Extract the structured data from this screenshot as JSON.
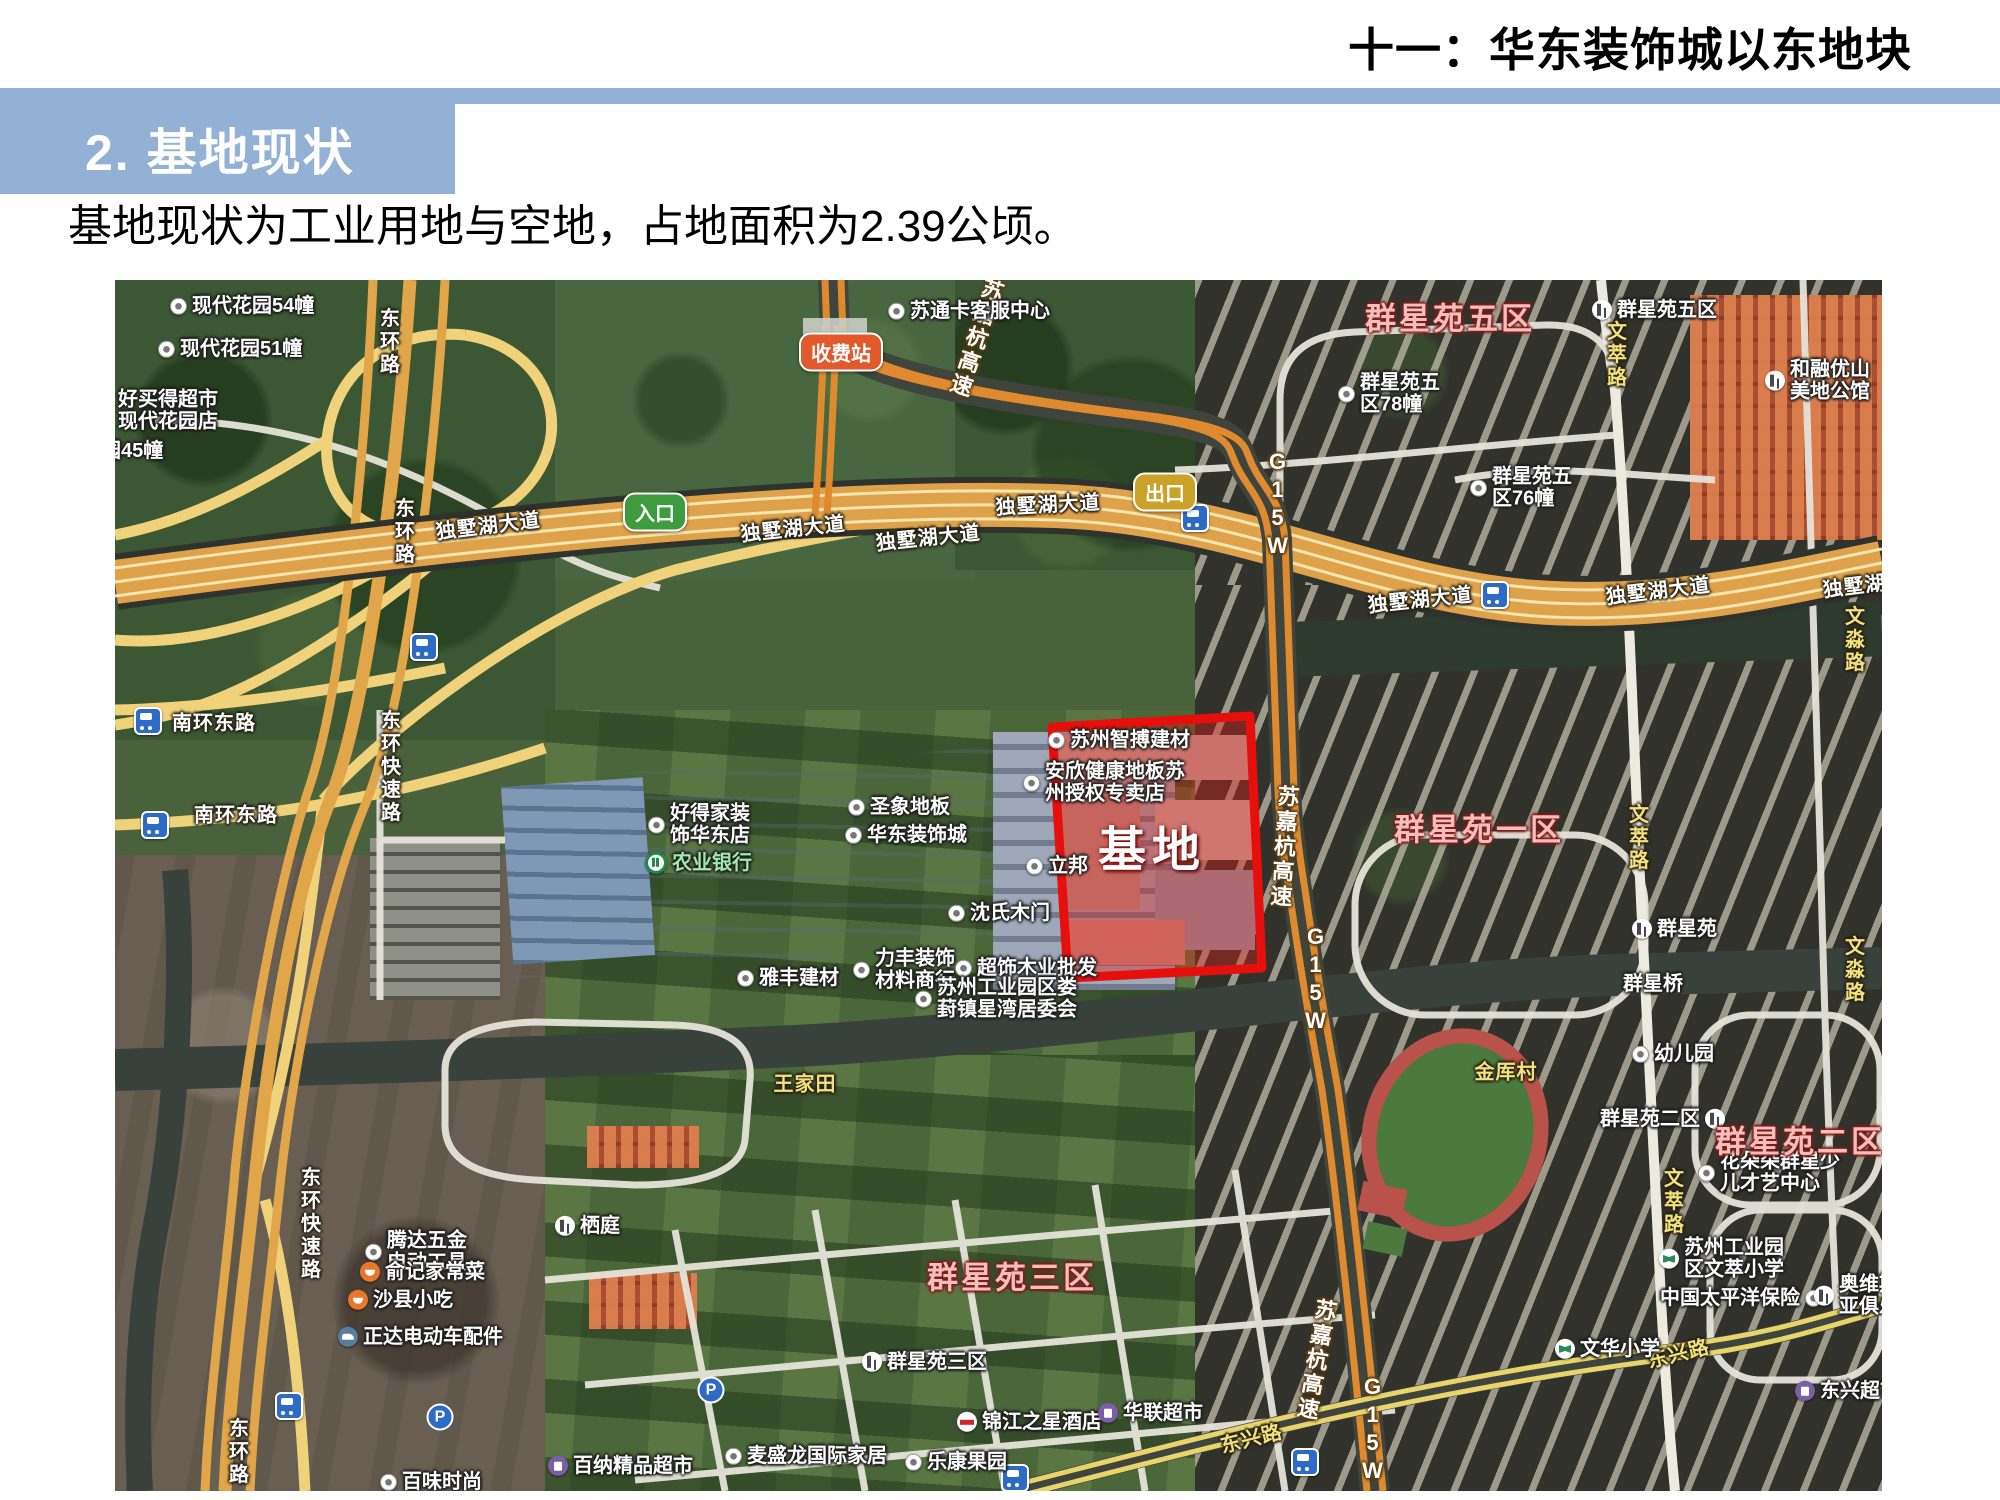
{
  "page": {
    "top_title": "十一：华东装饰城以东地块",
    "section_header": "2. 基地现状",
    "body_text": "基地现状为工业用地与空地，占地面积为2.39公顷。",
    "accent_color": "#92B1D5"
  },
  "map": {
    "site": {
      "label": "基地",
      "outline_color": "#E8100C",
      "x": 1037,
      "y": 565
    },
    "badges": [
      {
        "text": "收费站",
        "x": 726,
        "y": 72,
        "bg": "#E2592B"
      },
      {
        "text": "入口",
        "x": 540,
        "y": 232,
        "bg": "#3E9B3E"
      },
      {
        "text": "出口",
        "x": 1050,
        "y": 212,
        "bg": "#C9A227"
      }
    ],
    "pois": [
      {
        "l": [
          "现代花园54幢"
        ],
        "x": 55,
        "y": 26,
        "i": "dot"
      },
      {
        "l": [
          "现代花园51幢"
        ],
        "x": 43,
        "y": 69,
        "i": "dot"
      },
      {
        "l": [
          "好买得超市",
          "现代花园店"
        ],
        "x": 3,
        "y": 131
      },
      {
        "l": [
          "园45幢"
        ],
        "x": -14,
        "y": 171
      },
      {
        "l": [
          "苏通卡客服中心"
        ],
        "x": 773,
        "y": 31,
        "i": "dot"
      },
      {
        "l": [
          "群星苑五",
          "区78幢"
        ],
        "x": 1223,
        "y": 114,
        "i": "dot"
      },
      {
        "l": [
          "群星苑五",
          "区76幢"
        ],
        "x": 1355,
        "y": 208,
        "i": "dot"
      },
      {
        "l": [
          "群星苑五区"
        ],
        "x": 1477,
        "y": 30,
        "i": "building"
      },
      {
        "l": [
          "和融优山",
          "美地公馆"
        ],
        "x": 1650,
        "y": 101,
        "i": "building"
      },
      {
        "l": [
          "苏州智搏建材"
        ],
        "x": 933,
        "y": 460,
        "i": "dot"
      },
      {
        "l": [
          "安欣健康地板苏",
          "州授权专卖店"
        ],
        "x": 908,
        "y": 503,
        "i": "dot"
      },
      {
        "l": [
          "立邦"
        ],
        "x": 911,
        "y": 586,
        "i": "dot"
      },
      {
        "l": [
          "好得家装",
          "饰华东店"
        ],
        "x": 533,
        "y": 545,
        "i": "dot"
      },
      {
        "l": [
          "农业银行"
        ],
        "x": 530,
        "y": 583,
        "i": "bank",
        "c": "#9FE8B2"
      },
      {
        "l": [
          "圣象地板"
        ],
        "x": 733,
        "y": 527,
        "i": "dot"
      },
      {
        "l": [
          "华东装饰城"
        ],
        "x": 730,
        "y": 555,
        "i": "dot"
      },
      {
        "l": [
          "沈氏木门"
        ],
        "x": 833,
        "y": 633,
        "i": "dot"
      },
      {
        "l": [
          "雅丰建材"
        ],
        "x": 622,
        "y": 698,
        "i": "dot"
      },
      {
        "l": [
          "力丰装饰",
          "材料商行"
        ],
        "x": 738,
        "y": 690,
        "i": "dot"
      },
      {
        "l": [
          "超饰木业批发"
        ],
        "x": 840,
        "y": 688,
        "i": "dot"
      },
      {
        "l": [
          "苏州工业园区娄",
          "葑镇星湾居委会"
        ],
        "x": 800,
        "y": 719,
        "i": "dot"
      },
      {
        "l": [
          "群星苑"
        ],
        "x": 1517,
        "y": 649,
        "i": "building"
      },
      {
        "l": [
          "群星桥"
        ],
        "x": 1508,
        "y": 704
      },
      {
        "l": [
          "幼儿园"
        ],
        "x": 1517,
        "y": 774,
        "i": "dot"
      },
      {
        "l": [
          "群星苑二区"
        ],
        "x": 1485,
        "y": 839,
        "i": "building",
        "ir": true
      },
      {
        "l": [
          "花朵朵群星少",
          "儿才艺中心"
        ],
        "x": 1583,
        "y": 893,
        "i": "dot"
      },
      {
        "l": [
          "苏州工业园",
          "区文萃小学"
        ],
        "x": 1544,
        "y": 979,
        "i": "school"
      },
      {
        "l": [
          "中国太平洋保险"
        ],
        "x": 1545,
        "y": 1018,
        "i": "dot",
        "ir": true
      },
      {
        "l": [
          "奥维斯",
          "亚俱乐部"
        ],
        "x": 1699,
        "y": 1016,
        "i": "building"
      },
      {
        "l": [
          "文华小学"
        ],
        "x": 1440,
        "y": 1069,
        "i": "school"
      },
      {
        "l": [
          "栖庭"
        ],
        "x": 440,
        "y": 946,
        "i": "building"
      },
      {
        "l": [
          "腾达五金",
          "电动工具"
        ],
        "x": 250,
        "y": 972,
        "i": "dot"
      },
      {
        "l": [
          "俞记家常菜"
        ],
        "x": 245,
        "y": 992,
        "i": "rest"
      },
      {
        "l": [
          "沙县小吃"
        ],
        "x": 233,
        "y": 1020,
        "i": "rest"
      },
      {
        "l": [
          "正达电动车配件"
        ],
        "x": 223,
        "y": 1057,
        "i": "car"
      },
      {
        "l": [
          "群星苑三区"
        ],
        "x": 747,
        "y": 1082,
        "i": "building"
      },
      {
        "l": [
          "麦盛龙国际家居"
        ],
        "x": 610,
        "y": 1176,
        "i": "dot"
      },
      {
        "l": [
          "锦江之星酒店"
        ],
        "x": 842,
        "y": 1142,
        "i": "hotel"
      },
      {
        "l": [
          "华联超市"
        ],
        "x": 983,
        "y": 1133,
        "i": "shop"
      },
      {
        "l": [
          "乐康果园"
        ],
        "x": 790,
        "y": 1182,
        "i": "dot"
      },
      {
        "l": [
          "百纳精品超市"
        ],
        "x": 433,
        "y": 1186,
        "i": "shop"
      },
      {
        "l": [
          "东兴超市"
        ],
        "x": 1680,
        "y": 1111,
        "i": "shop"
      },
      {
        "l": [
          "百味时尚"
        ],
        "x": 265,
        "y": 1202,
        "i": "dot"
      }
    ],
    "districts": [
      {
        "t": "群星苑五区",
        "x": 1335,
        "y": 36
      },
      {
        "t": "群星苑一区",
        "x": 1364,
        "y": 547
      },
      {
        "t": "群星苑三区",
        "x": 897,
        "y": 995
      },
      {
        "t": "群星苑二区",
        "x": 1685,
        "y": 859
      }
    ],
    "road_labels": [
      {
        "t": "东环路",
        "x": 273,
        "y": 62,
        "v": true
      },
      {
        "t": "东环路",
        "x": 288,
        "y": 252,
        "v": true
      },
      {
        "t": "东环快速路",
        "x": 274,
        "y": 487,
        "v": true
      },
      {
        "t": "东环快速路",
        "x": 194,
        "y": 944,
        "v": true
      },
      {
        "t": "东环路",
        "x": 122,
        "y": 1172,
        "v": true
      },
      {
        "t": "南环东路",
        "x": 99,
        "y": 441
      },
      {
        "t": "南环东路",
        "x": 121,
        "y": 533
      },
      {
        "t": "独墅湖大道",
        "x": 373,
        "y": 244,
        "r": -7
      },
      {
        "t": "独墅湖大道",
        "x": 678,
        "y": 247,
        "r": -6
      },
      {
        "t": "独墅湖大道",
        "x": 813,
        "y": 256,
        "r": -6
      },
      {
        "t": "独墅湖大道",
        "x": 933,
        "y": 223,
        "r": -3
      },
      {
        "t": "独墅湖大道",
        "x": 1305,
        "y": 318,
        "r": -6
      },
      {
        "t": "独墅湖大道",
        "x": 1543,
        "y": 309,
        "r": -7
      },
      {
        "t": "独墅湖大道",
        "x": 1760,
        "y": 302,
        "r": -7
      },
      {
        "t": "文萃路",
        "x": 1500,
        "y": 75,
        "v": true,
        "yel": true
      },
      {
        "t": "文萃路",
        "x": 1522,
        "y": 558,
        "v": true,
        "yel": true
      },
      {
        "t": "文萃路",
        "x": 1557,
        "y": 922,
        "v": true,
        "yel": true
      },
      {
        "t": "文淼路",
        "x": 1738,
        "y": 360,
        "v": true,
        "yel": true
      },
      {
        "t": "文淼路",
        "x": 1738,
        "y": 690,
        "v": true,
        "yel": true
      },
      {
        "t": "王家田",
        "x": 690,
        "y": 802,
        "yel": true
      },
      {
        "t": "金厍村",
        "x": 1391,
        "y": 790,
        "yel": true
      },
      {
        "t": "东兴路",
        "x": 1136,
        "y": 1157,
        "r": -14,
        "yel": true
      },
      {
        "t": "东兴路",
        "x": 1563,
        "y": 1072,
        "r": -14,
        "yel": true
      }
    ],
    "highway_labels": [
      {
        "t": "苏嘉杭高速",
        "x": 860,
        "y": 58,
        "v": true,
        "r": 18
      },
      {
        "t": "G15W",
        "x": 1162,
        "y": 225,
        "v": true
      },
      {
        "t": "苏嘉杭高速",
        "x": 1168,
        "y": 567,
        "v": true,
        "r": 4
      },
      {
        "t": "G15W",
        "x": 1200,
        "y": 700,
        "v": true
      },
      {
        "t": "苏嘉杭高速",
        "x": 1200,
        "y": 1080,
        "v": true,
        "r": 10
      },
      {
        "t": "G15W",
        "x": 1257,
        "y": 1150,
        "v": true
      }
    ],
    "bus_stops": [
      {
        "x": 33,
        "y": 441
      },
      {
        "x": 40,
        "y": 545
      },
      {
        "x": 309,
        "y": 367
      },
      {
        "x": 1380,
        "y": 315
      },
      {
        "x": 1080,
        "y": 238
      },
      {
        "x": 900,
        "y": 1198
      },
      {
        "x": 1190,
        "y": 1182
      },
      {
        "x": 174,
        "y": 1126
      }
    ],
    "parking": [
      {
        "x": 596,
        "y": 1110
      },
      {
        "x": 325,
        "y": 1137
      }
    ]
  }
}
